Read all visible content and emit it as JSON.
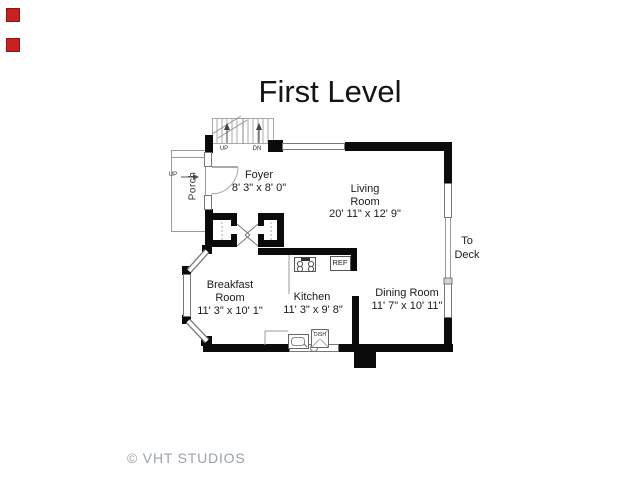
{
  "title": "First Level",
  "watermark": "© VHT STUDIOS",
  "rooms": {
    "foyer": {
      "name": "Foyer",
      "dims": "8' 3\" x 8' 0\""
    },
    "living": {
      "line1": "Living",
      "line2": "Room",
      "dims": "20' 11\" x 12' 9\""
    },
    "kitchen": {
      "name": "Kitchen",
      "dims": "11' 3\" x 9' 8\""
    },
    "breakfast": {
      "line1": "Breakfast",
      "line2": "Room",
      "dims": "11' 3\" x 10' 1\""
    },
    "dining": {
      "name": "Dining Room",
      "dims": "11' 7\" x 10' 11\""
    },
    "porch": {
      "name": "Porch",
      "step_label": "UP"
    }
  },
  "stairs": {
    "up": "UP",
    "down": "DN"
  },
  "fixtures": {
    "refrigerator": "REF",
    "dishwasher": "DISH"
  },
  "exterior": {
    "deck_line1": "To",
    "deck_line2": "Deck"
  },
  "colors": {
    "wall": "#0b0b0b",
    "window_line": "#777777",
    "thin_line": "#999999",
    "text": "#1b1b1b",
    "watermark": "#9aa1ac",
    "marker_red": "#c92121"
  }
}
